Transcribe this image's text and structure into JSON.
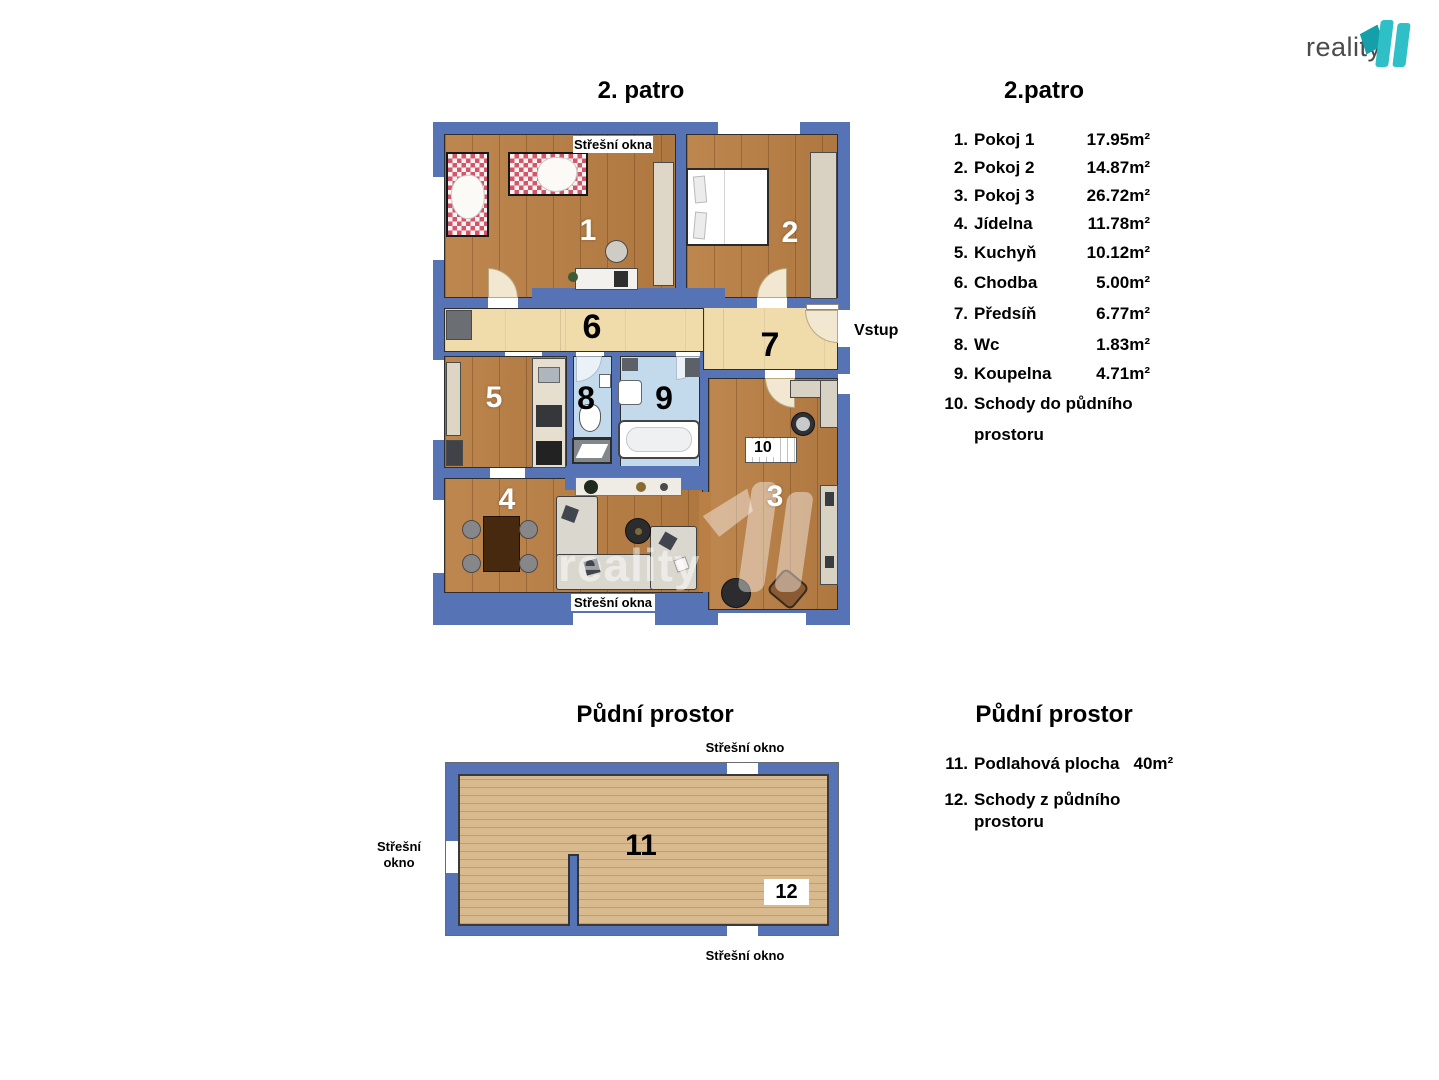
{
  "colors": {
    "wall_blue": "#5673b5",
    "wood_floor": "#b97f44",
    "corridor_floor": "#f0dcab",
    "bathroom_floor": "#c3d9ec",
    "attic_floor": "#d8ba8e",
    "brand_teal": "#2fbfc7",
    "brand_teal_dark": "#149fa9",
    "logo_text_gray": "#4b4b4b"
  },
  "logo": {
    "text": "reality"
  },
  "watermark": {
    "text": "reality"
  },
  "upper": {
    "plan_title": "2. patro",
    "legend_title": "2.patro",
    "labels": {
      "roof_top": "Střešní okna",
      "roof_bottom": "Střešní okna",
      "entrance": "Vstup"
    },
    "room_labels": {
      "r1": "1",
      "r2": "2",
      "r3": "3",
      "r4": "4",
      "r5": "5",
      "r6": "6",
      "r7": "7",
      "r8": "8",
      "r9": "9",
      "r10": "10"
    },
    "legend": [
      {
        "num": "1.",
        "name": "Pokoj 1",
        "area": "17.95m²"
      },
      {
        "num": "2.",
        "name": "Pokoj 2",
        "area": "14.87m²"
      },
      {
        "num": "3.",
        "name": "Pokoj 3",
        "area": "26.72m²"
      },
      {
        "num": "4.",
        "name": "Jídelna",
        "area": "11.78m²"
      },
      {
        "num": "5.",
        "name": "Kuchyň",
        "area": "10.12m²"
      },
      {
        "num": "6.",
        "name": "Chodba",
        "area": "5.00m²"
      },
      {
        "num": "7.",
        "name": "Předsíň",
        "area": "6.77m²"
      },
      {
        "num": "8.",
        "name": "Wc",
        "area": "1.83m²"
      },
      {
        "num": "9.",
        "name": "Koupelna",
        "area": "4.71m²"
      },
      {
        "num": "10.",
        "name": "Schody do půdního",
        "name2": "prostoru",
        "area": ""
      }
    ]
  },
  "lower": {
    "plan_title": "Půdní prostor",
    "legend_title": "Půdní prostor",
    "labels": {
      "roof_top": "Střešní okno",
      "roof_bottom": "Střešní okno",
      "roof_left_1": "Střešní",
      "roof_left_2": "okno"
    },
    "room_labels": {
      "r11": "11",
      "r12": "12"
    },
    "legend": [
      {
        "num": "11.",
        "name": "Podlahová plocha",
        "area": "40m²"
      },
      {
        "num": "12.",
        "name": "Schody z půdního",
        "name2": "prostoru",
        "area": ""
      }
    ]
  }
}
